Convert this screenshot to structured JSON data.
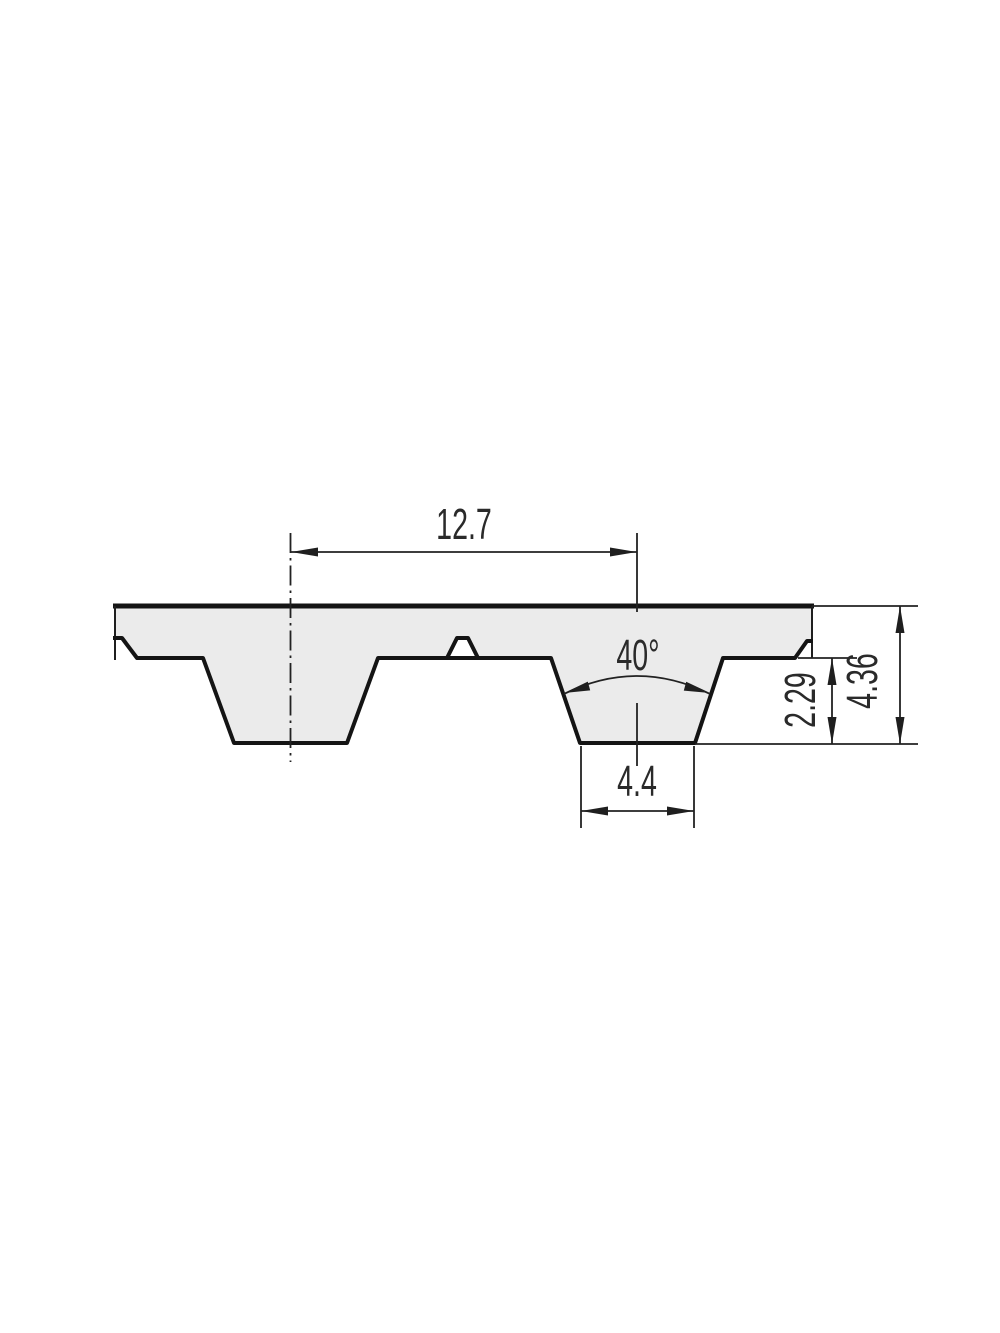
{
  "drawing": {
    "kind": "technical cross-section drawing of a trapezoidal timing belt tooth profile",
    "dimensions": {
      "pitch": "12.7",
      "tooth_angle": "40°",
      "tooth_tip_width": "4.4",
      "tooth_height": "2.29",
      "belt_thickness": "4.36"
    },
    "colors": {
      "belt_fill": "#ebebeb",
      "outline": "#141414",
      "dimension_lines": "#222222",
      "text": "#2a2a2a",
      "background": "#ffffff"
    }
  }
}
